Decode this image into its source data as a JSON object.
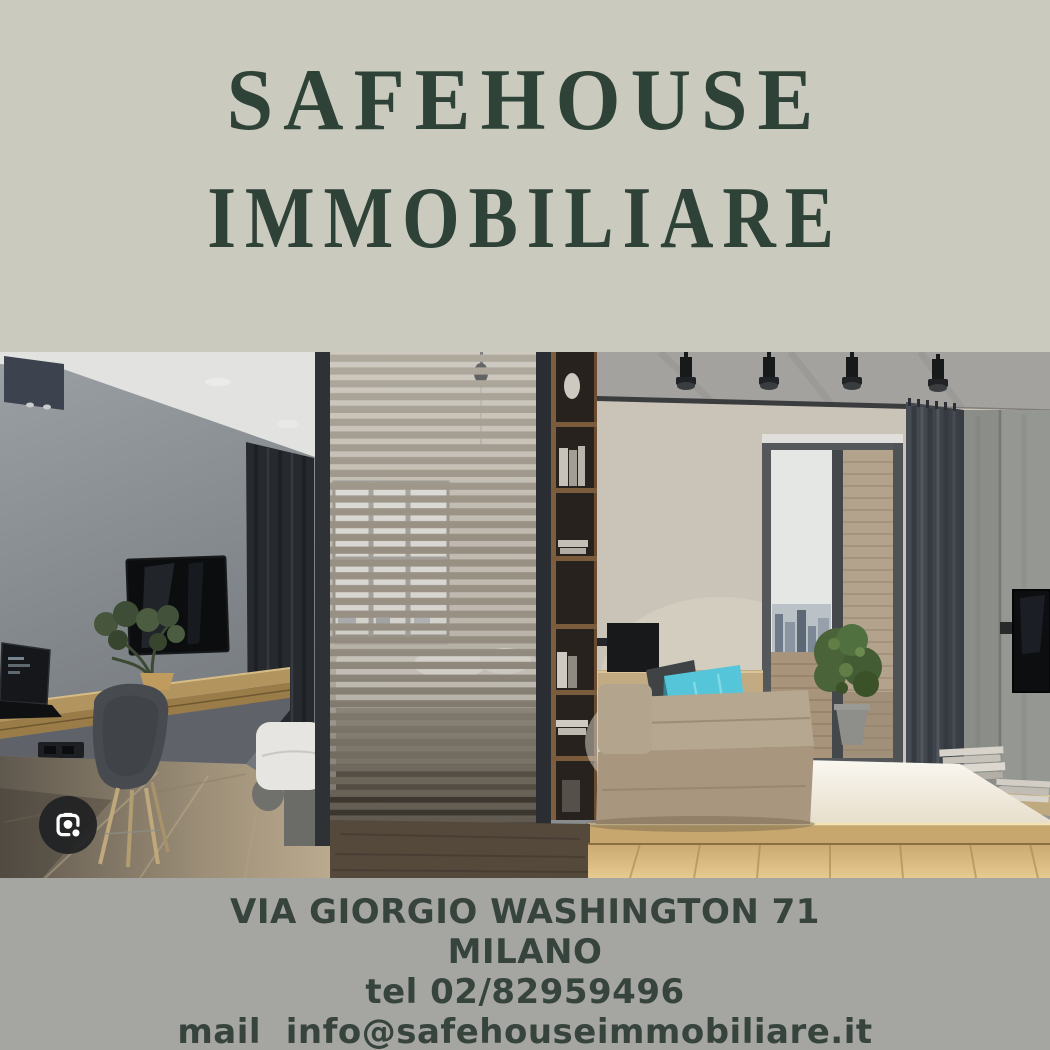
{
  "header": {
    "title_line1": "SAFEHOUSE",
    "title_line2": "IMMOBILIARE"
  },
  "photo": {
    "alt": "Modern studio apartment: slatted wood room divider, wall TV and desk area on the left, daybed with turquoise cushion and balcony door on the right",
    "lens_icon": "google-lens-camera-icon"
  },
  "footer": {
    "address": "VIA GIORGIO WASHINGTON 71",
    "city": "MILANO",
    "phone": "tel 02/82959496",
    "email": "mail  info@safehouseimmobiliare.it"
  },
  "colors": {
    "top_background": "#cacabf",
    "title_text": "#2e4237",
    "footer_background": "#a5a5a2",
    "footer_text": "#37443d",
    "lens_circle": "#202124",
    "accent_pillow": "#55c5d9"
  }
}
